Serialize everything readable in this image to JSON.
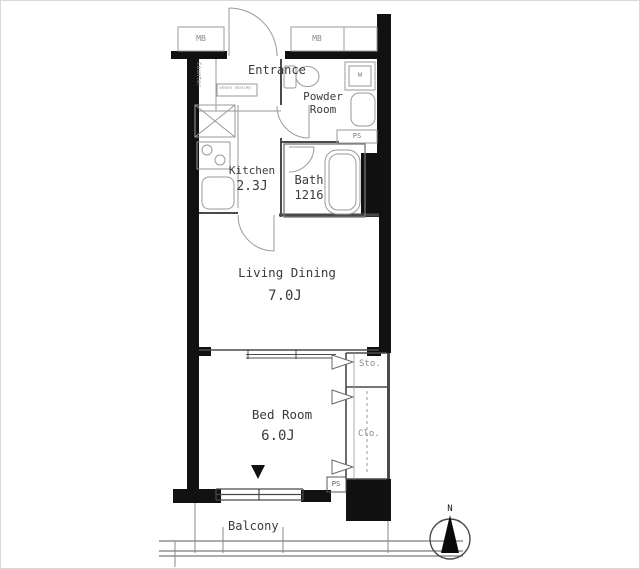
{
  "plan": {
    "rooms": {
      "entrance": {
        "label": "Entrance",
        "note": "Shoes Box(W)"
      },
      "powder_room": {
        "line1": "Powder",
        "line2": "Room"
      },
      "kitchen": {
        "label": "Kitchen",
        "size": "2.3J"
      },
      "bath": {
        "label": "Bath",
        "size": "1216"
      },
      "living_dining": {
        "label": "Living Dining",
        "size": "7.0J"
      },
      "bed_room": {
        "label": "Bed Room",
        "size": "6.0J"
      },
      "balcony": {
        "label": "Balcony"
      }
    },
    "labels": {
      "counter": "Counter",
      "washer": "W",
      "meter_box_left": "MB",
      "meter_box_right": "MB",
      "pipe_shaft_upper": "PS",
      "pipe_shaft_lower": "PS",
      "storage": "Sto.",
      "closet": "Clo.",
      "north": "N"
    },
    "colors": {
      "wall": "#111111",
      "line_medium": "#4a4a4a",
      "line_light": "#9a9a9a",
      "text": "#3a3a3a",
      "bg": "#ffffff"
    }
  }
}
